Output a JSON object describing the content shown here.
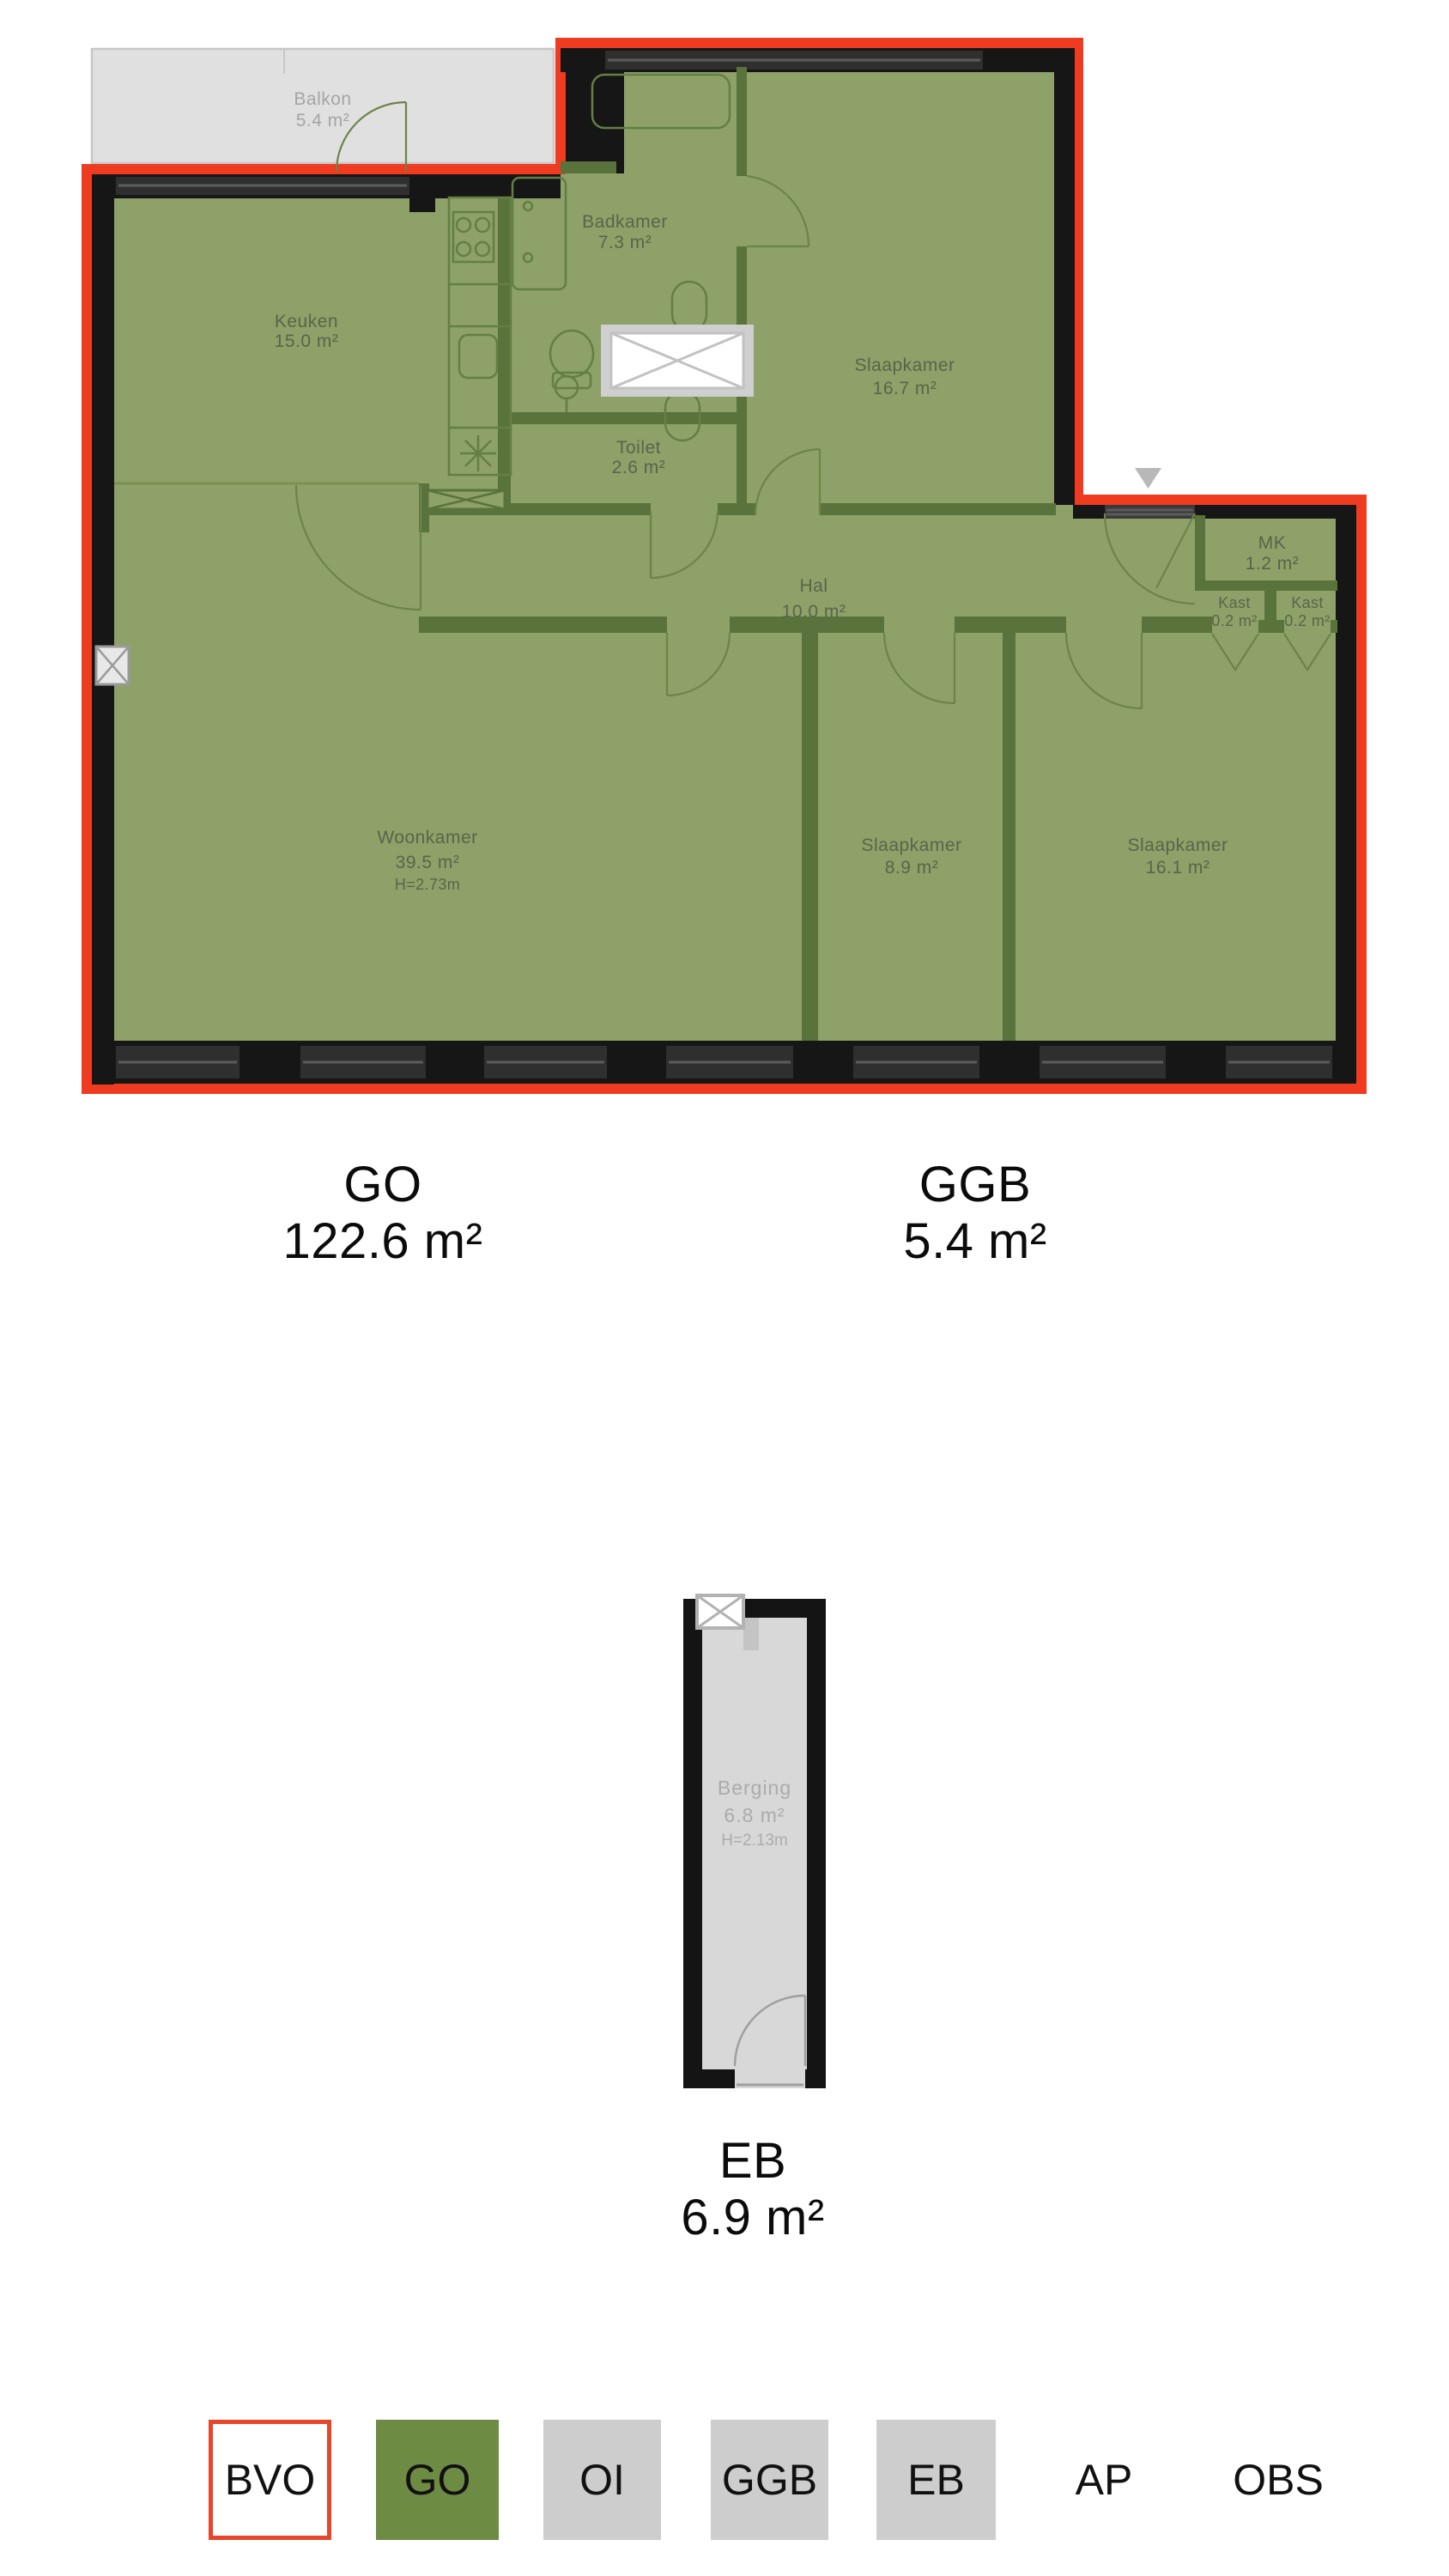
{
  "plan_main": {
    "rooms": {
      "balkon": {
        "name": "Balkon",
        "area": "5.4 m²"
      },
      "keuken": {
        "name": "Keuken",
        "area": "15.0 m²"
      },
      "badkamer": {
        "name": "Badkamer",
        "area": "7.3 m²"
      },
      "toilet": {
        "name": "Toilet",
        "area": "2.6 m²"
      },
      "slaapkamer1": {
        "name": "Slaapkamer",
        "area": "16.7 m²"
      },
      "hal": {
        "name": "Hal",
        "area": "10.0 m²"
      },
      "mk": {
        "name": "MK",
        "area": "1.2 m²"
      },
      "kast1": {
        "name": "Kast",
        "area": "0.2 m²"
      },
      "kast2": {
        "name": "Kast",
        "area": "0.2 m²"
      },
      "woonkamer": {
        "name": "Woonkamer",
        "area": "39.5 m²",
        "height": "H=2.73m"
      },
      "slaapkamer2": {
        "name": "Slaapkamer",
        "area": "8.9 m²"
      },
      "slaapkamer3": {
        "name": "Slaapkamer",
        "area": "16.1 m²"
      }
    },
    "area_labels": {
      "go": {
        "code": "GO",
        "value": "122.6 m²"
      },
      "ggb": {
        "code": "GGB",
        "value": "5.4 m²"
      }
    }
  },
  "plan_storage": {
    "room": {
      "name": "Berging",
      "area": "6.8 m²",
      "height": "H=2.13m"
    },
    "area_label": {
      "code": "EB",
      "value": "6.9 m²"
    }
  },
  "legend": {
    "items": [
      {
        "label": "BVO",
        "swatch": "outlined-red"
      },
      {
        "label": "GO",
        "swatch": "green"
      },
      {
        "label": "OI",
        "swatch": "gray"
      },
      {
        "label": "GGB",
        "swatch": "gray"
      },
      {
        "label": "EB",
        "swatch": "gray"
      },
      {
        "label": "AP",
        "swatch": "none"
      },
      {
        "label": "OBS",
        "swatch": "none"
      }
    ]
  },
  "colors": {
    "outline_red": "#ef3b20",
    "plan_green": "#8da168",
    "wall_green": "#5a733c",
    "legend_green": "#6e8b44",
    "legend_gray": "#cdcdcd",
    "balcony_gray": "#e0e0e0"
  }
}
